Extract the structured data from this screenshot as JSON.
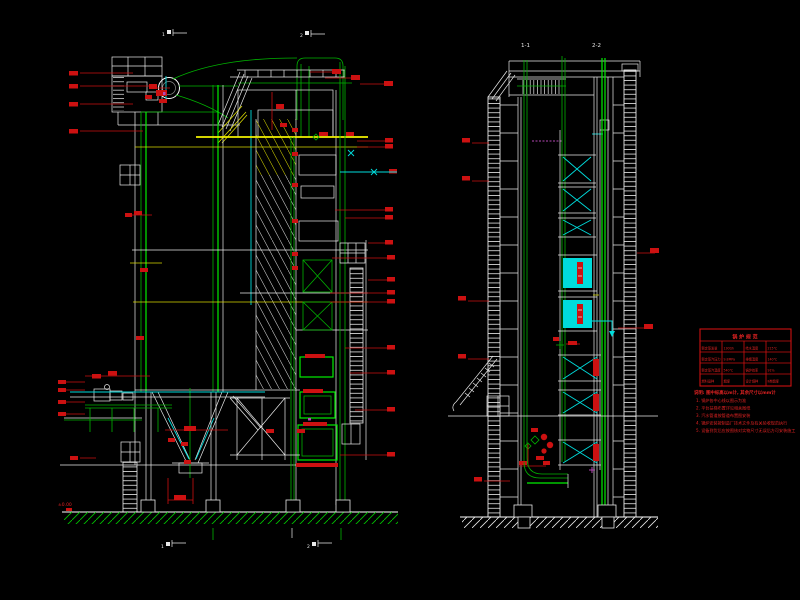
{
  "drawing": {
    "section_markers": {
      "top_left": "1",
      "top_right": "2",
      "bottom_left": "1",
      "bottom_right": "2"
    },
    "side_view_labels": {
      "left": "1-1",
      "right": "2-2"
    },
    "ground_elevation": "±0.00"
  },
  "spec_table": {
    "title": "锅 炉 规 范",
    "rows": [
      [
        "额定蒸发量",
        "130t/h",
        "给水温度",
        "215℃"
      ],
      [
        "额定蒸汽压力",
        "9.8MPa",
        "排烟温度",
        "140℃"
      ],
      [
        "额定蒸汽温度",
        "540℃",
        "锅炉效率",
        "91%"
      ],
      [
        "燃料品种",
        "烟煤",
        "设计煤种",
        "Ⅱ类烟煤"
      ]
    ]
  },
  "notes": {
    "header": "说明: 图中标高以m计, 其余尺寸以mm计",
    "items": [
      "1. 锅炉各中心线以图示为准",
      "2. 平台扶梯布置详见相关图纸",
      "3. 汽水管道按管道布置图安装",
      "4. 锅炉安装按制造厂技术文件及有关验收规范执行",
      "5. 设备到货后应按图核对实物尺寸无误后方可安装施工"
    ]
  },
  "colors": {
    "background": "#000000",
    "line_white": "#e8e8e8",
    "line_green": "#00b400",
    "line_bright_green": "#00ee00",
    "line_yellow": "#f2f200",
    "line_cyan": "#00dcdc",
    "annotation_red": "#cc1111",
    "line_magenta": "#b448b4"
  }
}
